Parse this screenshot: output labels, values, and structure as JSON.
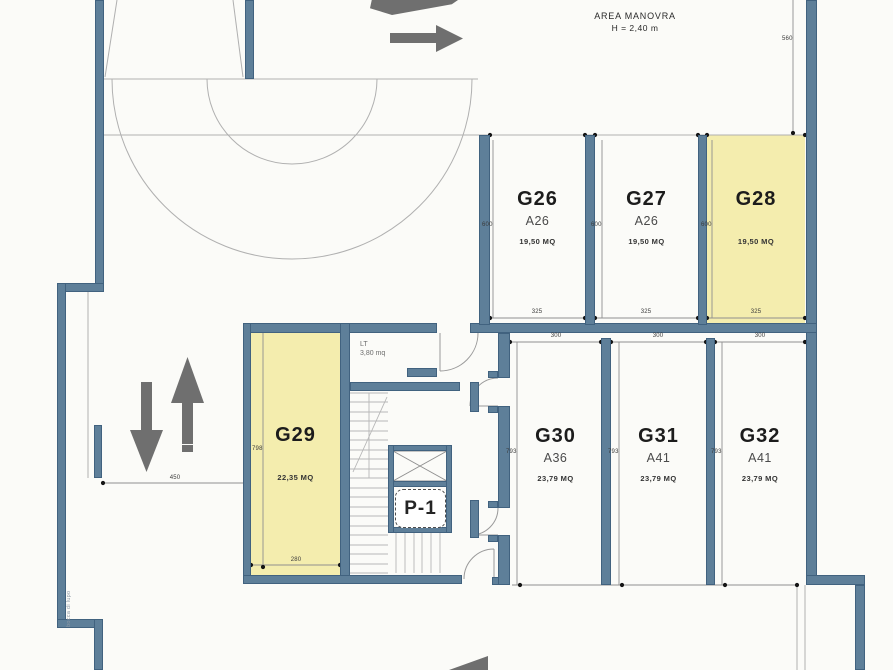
{
  "plan": {
    "area_manovra": {
      "title": "AREA MANOVRA",
      "height_note": "H = 2,40 m"
    },
    "garages": [
      {
        "id": "G26",
        "type": "A26",
        "area": "19,50 MQ",
        "highlighted": false
      },
      {
        "id": "G27",
        "type": "A26",
        "area": "19,50 MQ",
        "highlighted": false
      },
      {
        "id": "G28",
        "type": "",
        "area": "19,50 MQ",
        "highlighted": true
      },
      {
        "id": "G29",
        "type": "",
        "area": "22,35 MQ",
        "highlighted": true
      },
      {
        "id": "G30",
        "type": "A36",
        "area": "23,79 MQ",
        "highlighted": false
      },
      {
        "id": "G31",
        "type": "A41",
        "area": "23,79 MQ",
        "highlighted": false
      },
      {
        "id": "G32",
        "type": "A41",
        "area": "23,79 MQ",
        "highlighted": false
      }
    ],
    "rooms": {
      "technical": {
        "label": "LT",
        "area": "3,80 mq"
      },
      "elevator": {
        "label": "P-1"
      }
    },
    "annotations": {
      "side_note": "bocca di lupo"
    },
    "dimensions": {
      "d560": "560",
      "d600": "600",
      "d325": "325",
      "d300": "300",
      "d793": "793",
      "d798": "798",
      "d280": "280",
      "d450": "450"
    },
    "colors": {
      "wall": "#5e7f99",
      "highlight": "#f4edae",
      "arrow": "#6f6f6f"
    }
  }
}
